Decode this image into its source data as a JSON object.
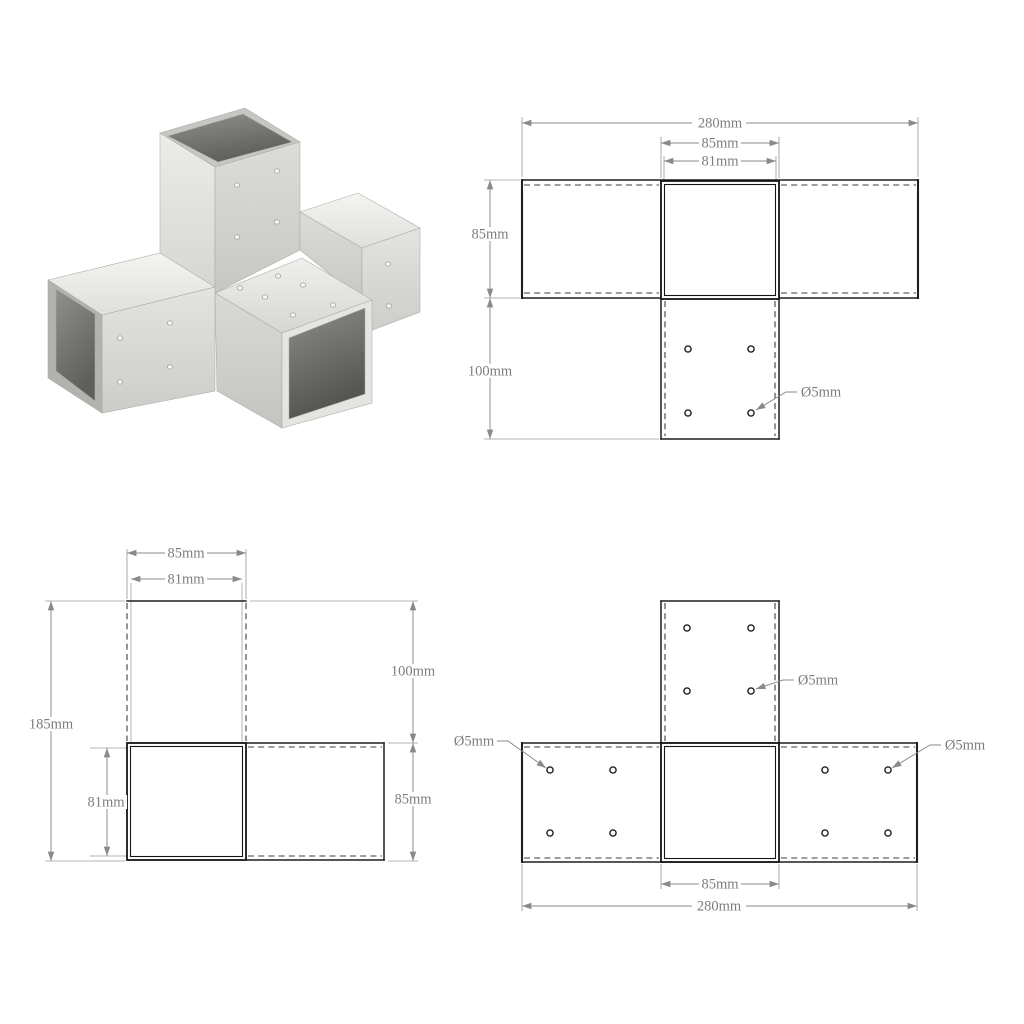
{
  "page": {
    "background": "#ffffff"
  },
  "colors": {
    "object_line": "#1f1f1f",
    "hidden_line": "#3d3d3d",
    "dimension_line": "#8a8a8a",
    "dimension_text": "#7d7d7d",
    "metal_light": "#f4f4f1",
    "metal_mid": "#dcdcd9",
    "metal_dark": "#b2b2af",
    "metal_inner": "#5e5e5b"
  },
  "product_render": {
    "subject": "x-form-post-connector",
    "material": "galvanised-metal"
  },
  "diagrams": {
    "top_view": {
      "total_width": "280mm",
      "square_outer": "85mm",
      "square_inner": "81mm",
      "arm_depth": "85mm",
      "plate_length": "100mm",
      "hole_diameter": "Ø5mm"
    },
    "side_view": {
      "square_outer": "85mm",
      "square_inner": "81mm",
      "total_height": "185mm",
      "plate_length": "100mm",
      "arm_height": "85mm",
      "inner_height": "81mm"
    },
    "front_view": {
      "hole_diameter_top": "Ø5mm",
      "hole_diameter_left": "Ø5mm",
      "hole_diameter_right": "Ø5mm",
      "square_outer": "85mm",
      "total_width": "280mm"
    }
  }
}
